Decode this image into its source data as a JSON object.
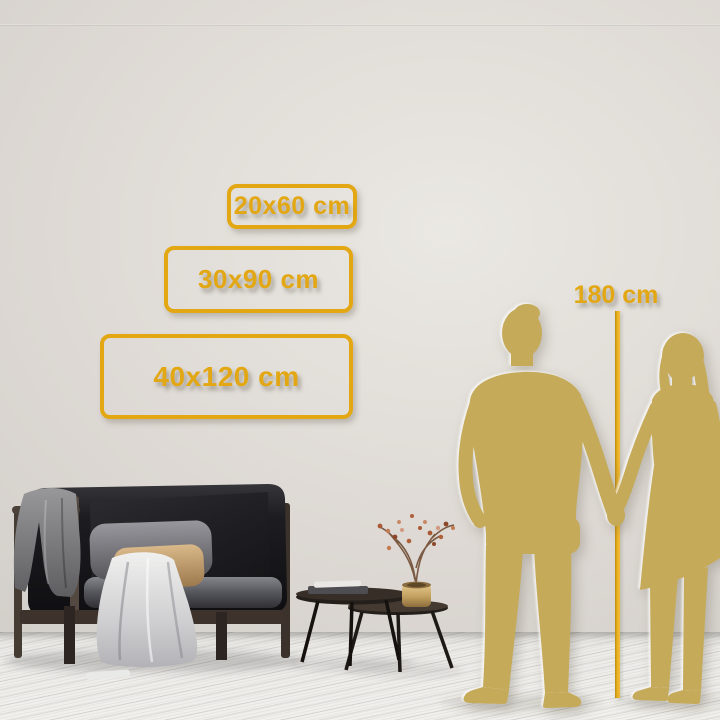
{
  "accent": {
    "gold": "#E2A713",
    "silhouette_gold": "#C5AA5A"
  },
  "size_options": [
    {
      "id": "20x60",
      "label": "20x60 cm"
    },
    {
      "id": "30x90",
      "label": "30x90 cm"
    },
    {
      "id": "40x120",
      "label": "40x120 cm"
    }
  ],
  "height_reference": {
    "label": "180 cm"
  }
}
